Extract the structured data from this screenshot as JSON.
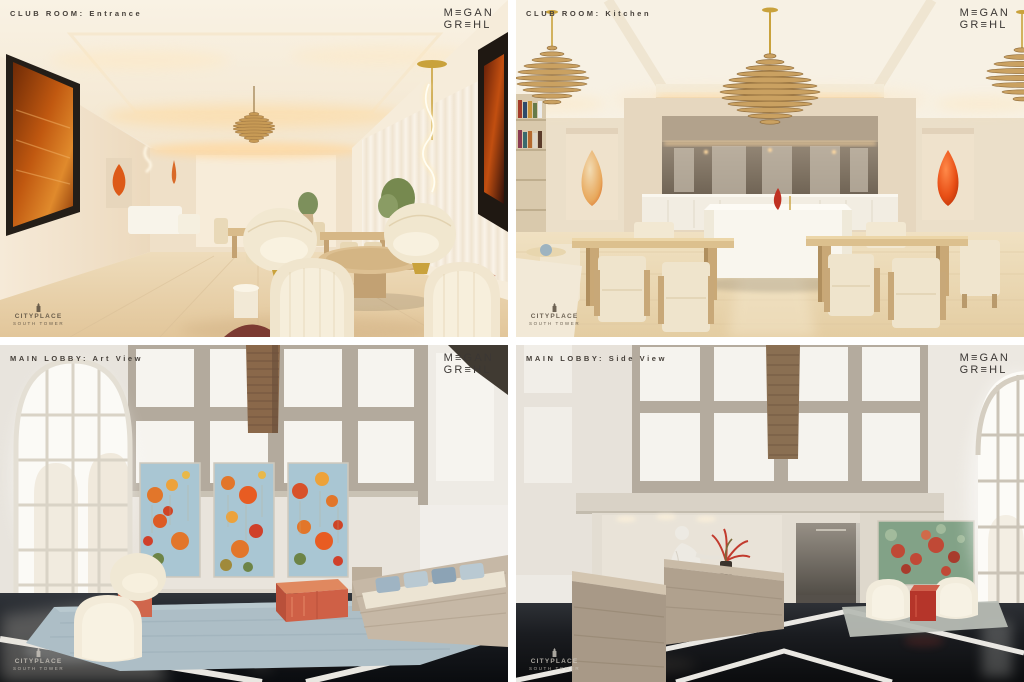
{
  "brand": {
    "name": "MEGAN GREHL",
    "logo_line1": "M≡GAN",
    "logo_line2": "GR≡HL",
    "text_color": "#3b3734"
  },
  "watermark": {
    "title": "CITYPLACE",
    "subtitle": "SOUTH TOWER"
  },
  "panels": [
    {
      "id": "club-room-entrance",
      "label": "CLUB ROOM: Entrance",
      "scene": "Long cream club lounge with cove-lit tray ceiling, oak floor, dark-framed amber abstract artwork, orange glass vessel in niche, dining tables, potted plants, gold rod pendant with white LED squiggle, wood slat globe pendant, and four striped swivel barrel chairs around a round oak cocktail table",
      "palette": {
        "wall": "#f3e7d4",
        "floor": "#e9d2ab",
        "cove_glow": "#ffd99c",
        "artwork_amber": "#b4500f",
        "accent_orange": "#e05a16"
      }
    },
    {
      "id": "club-room-kitchen",
      "label": "CLUB ROOM: Kitchen",
      "scene": "Symmetrical club kitchen with white stone island, mirrored back bar with warm cove light, wood-slat teardrop pendant chandeliers on brass rods, orange glass teardrop vessels in flanking wall niches, bookshelf, and oak dining tables with boucle cube chairs",
      "palette": {
        "wall": "#e9dbc4",
        "island": "#f8f5ee",
        "mirror": "#7f7263",
        "pendant_wood": "#c9a05e",
        "vase_red": "#e34a16"
      }
    },
    {
      "id": "main-lobby-art-view",
      "label": "MAIN LOBBY: Art View",
      "scene": "Double-height lobby with gridded clerestory panels, tall arched window, hanging woven wood column, triptych of blue and orange poppy abstract paintings, travertine bench with blue pillows, coral lacquer cube tables, cream swivel chairs, pale blue rug, polished black stone floor with white marble inlay and reflections",
      "palette": {
        "wall": "#efece7",
        "mullion": "#b3aa9d",
        "painting_blue": "#a9c6d3",
        "painting_orange": "#e2762a",
        "coral_table": "#cf6046",
        "rug": "#adbec6",
        "floor_black": "#101317"
      }
    },
    {
      "id": "main-lobby-side-view",
      "label": "MAIN LOBBY: Side View",
      "scene": "Lobby side view with stepped travertine reception desk, white figurative sculpture, coral red floral arrangement, dark corridor, green meadow abstract painting above two cream swivel chairs and red glass cube table, woven banner overhead, tall arched window, and glossy black floor with white diamond inlay",
      "palette": {
        "wall": "#eceae4",
        "stone_desk": "#ab9c8a",
        "painting_green": "#82a287",
        "accent_red": "#c04936",
        "floor_black": "#0e1012"
      }
    }
  ]
}
